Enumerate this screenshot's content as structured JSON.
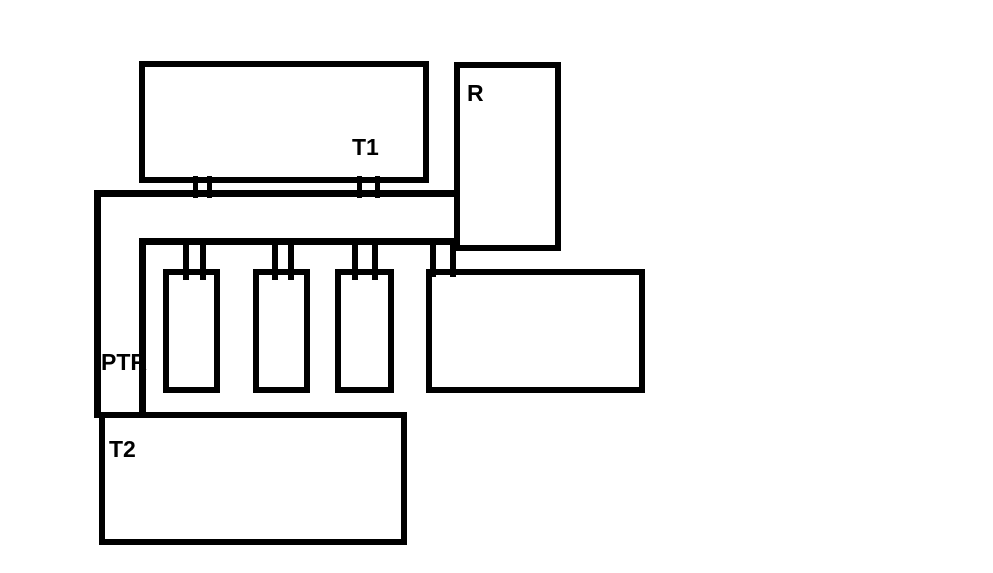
{
  "diagram": {
    "background_color": "#ffffff",
    "line_color": "#000000",
    "labels": {
      "t1": "T1",
      "r": "R",
      "ptr": "PTR",
      "t2": "T2"
    }
  }
}
